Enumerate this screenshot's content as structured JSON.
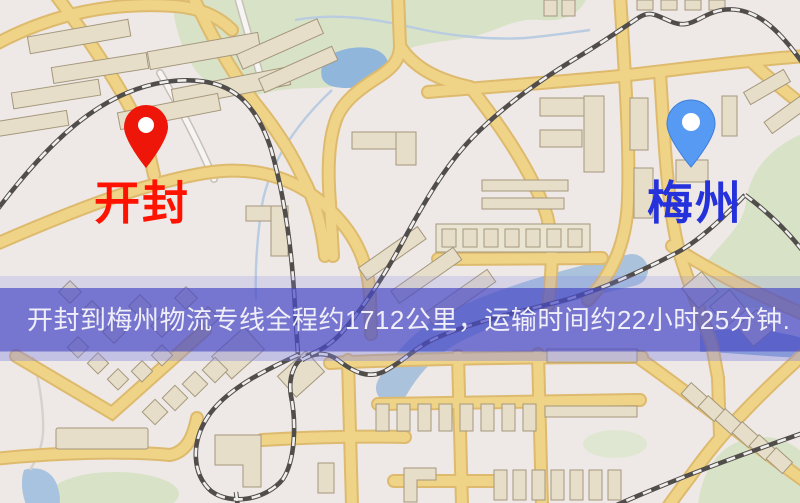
{
  "app": {
    "title": "物流专线地图"
  },
  "map": {
    "type": "road-map",
    "markers": [
      {
        "id": "origin",
        "city": "开封",
        "pin_color": "#ee1509",
        "pin_hole_color": "#ffffff",
        "label_color": "#ff1200"
      },
      {
        "id": "destination",
        "city": "梅州",
        "pin_color": "#569af4",
        "pin_stroke": "#3f7fd8",
        "pin_hole_color": "#ffffff",
        "label_color": "#2531da"
      }
    ]
  },
  "banner": {
    "text": "开封到梅州物流专线全程约1712公里，运输时间约22小时25分钟."
  },
  "colors": {
    "label_kaifeng": "#ff1200",
    "label_meizhou": "#2531da",
    "banner_bg": "rgba(72,74,199,0.72)",
    "banner_text": "#f0eef8",
    "road_yellow": "#f5d77e",
    "road_casing": "#e2ba62",
    "park_green": "#dce7c4",
    "water_blue": "#8cb6dd",
    "map_bg": "#f4efe8"
  }
}
